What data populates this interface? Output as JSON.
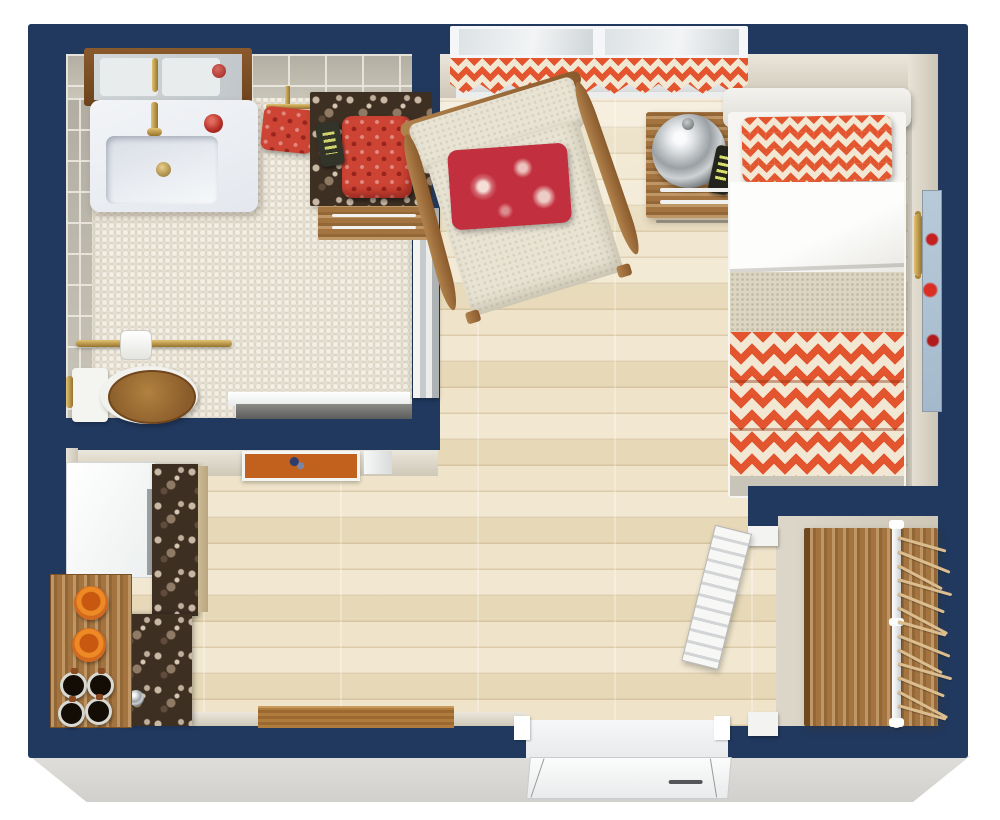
{
  "title": "3D Floor Plan — Studio Apartment (top-down view)",
  "rooms": {
    "bathroom": {
      "label": "Bathroom",
      "floor": "beige penny-tile mosaic",
      "items": [
        "wood-framed mirror",
        "white vanity sink with brass faucet and drain",
        "red candles",
        "brass towel ring with red towel",
        "terrazzo side table with folded red towels and remote",
        "brass grab bar",
        "toilet paper roll",
        "toilet with wooden seat",
        "brass wall hook",
        "white sliding pocket door"
      ]
    },
    "bedroom_living": {
      "label": "Bedroom / Living Area",
      "floor": "light maple plank",
      "items": [
        "double window with orange chevron valance",
        "cream armchair with wood arms and red floral pillow",
        "wooden nightstand",
        "chrome dome lamp",
        "black remote control",
        "single bed with orange chevron pillow, white sheet, linen blanket and chevron coverlet",
        "brass wall handle",
        "red-flower artwork on side wall",
        "orange framed artwork on bathroom wall",
        "wooden console table at bottom wall"
      ]
    },
    "kitchen": {
      "label": "Kitchenette",
      "items": [
        "white refrigerator",
        "dark terrazzo counter",
        "chrome cabinet knob",
        "wooden serving table",
        "orange bowls",
        "coffee mugs"
      ],
      "bowl_count": 2,
      "mug_count": 4
    },
    "closet": {
      "label": "Walk-in Closet",
      "items": [
        "white louvered door",
        "wooden wardrobe",
        "white hanging rod",
        "wooden hangers"
      ],
      "hanger_count": 13
    },
    "entry": {
      "label": "Entry",
      "items": [
        "white entry door, swing shown"
      ]
    }
  },
  "palette": {
    "wall_navy": "#21395f",
    "accent_orange": "#e2552e",
    "chevron_cream": "#f2e7d2",
    "wood_floor": "#ecdfc2",
    "furniture_wood": "#9a6b38",
    "terrazzo_brown": "#3e2f23",
    "tile_beige": "#d8d1c2",
    "red_accent": "#c0392b",
    "slab_gray": "#dbd9d6",
    "brass": "#c19a4c"
  }
}
